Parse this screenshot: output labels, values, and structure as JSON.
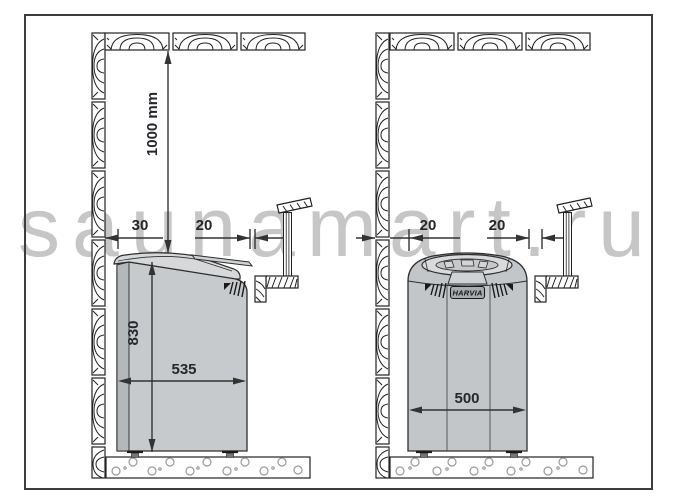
{
  "watermark": "saunamart.ru",
  "brand": "HARVIA",
  "left_heater": {
    "ceiling_clearance": "1000 mm",
    "wall_clearance": "30",
    "rail_clearance": "20",
    "height": "830",
    "width": "535"
  },
  "right_heater": {
    "wall_clearance": "20",
    "rail_clearance": "20",
    "width": "500"
  },
  "colors": {
    "line": "#2e2e2e",
    "dim_text": "#26262c",
    "watermark": "#c6c6c6",
    "heater_body_left": "#c7cacc",
    "heater_side_left": "#b4b8ba",
    "heater_lid_left": "#d6d8d9",
    "heater_body_right": "#c3c6c8",
    "heater_dome_right": "#d8dadc"
  }
}
